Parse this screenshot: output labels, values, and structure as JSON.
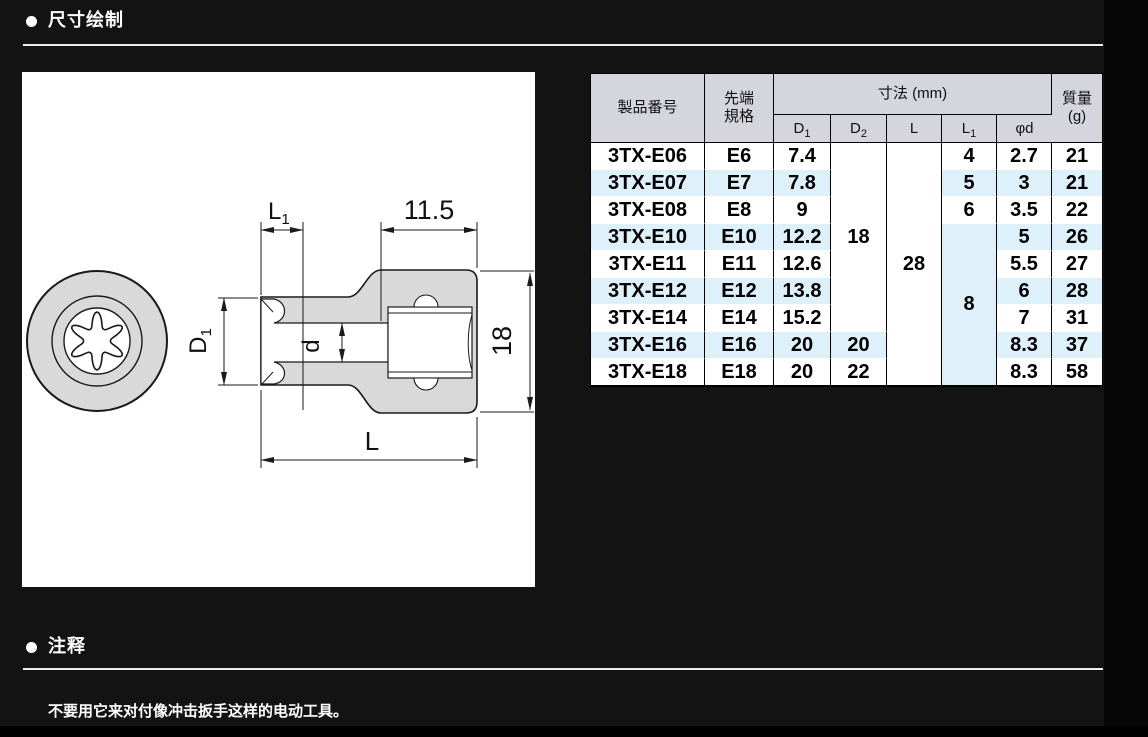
{
  "sections": {
    "drawing": {
      "title": "尺寸绘制"
    },
    "notes": {
      "title": "注释",
      "body": "不要用它来对付像冲击扳手这样的电动工具。"
    }
  },
  "drawing": {
    "labels": {
      "l1": {
        "base": "L",
        "sub": "1"
      },
      "top_width": "11.5",
      "d1": {
        "base": "D",
        "sub": "1"
      },
      "d": "d",
      "height": "18",
      "length": "L"
    }
  },
  "table": {
    "headers": {
      "product": "製品番号",
      "tip_line1": "先端",
      "tip_line2": "規格",
      "dims_group": "寸法 (mm)",
      "dims": [
        {
          "b": "D",
          "s": "1"
        },
        {
          "b": "D",
          "s": "2"
        },
        {
          "b": "L",
          "s": ""
        },
        {
          "b": "L",
          "s": "1"
        },
        {
          "b": "φd",
          "s": ""
        }
      ],
      "mass_line1": "質量",
      "mass_line2": "(g)"
    },
    "rows": [
      {
        "product": "3TX-E06",
        "tip": "E6",
        "d1": "7.4",
        "d1a": "r",
        "l1": "4",
        "phid": "2.7",
        "mass": "21"
      },
      {
        "product": "3TX-E07",
        "tip": "E7",
        "d1": "7.8",
        "d1a": "r",
        "l1": "5",
        "phid": "3",
        "mass": "21"
      },
      {
        "product": "3TX-E08",
        "tip": "E8",
        "d1": "9",
        "l1": "6",
        "phid": "3.5",
        "mass": "22"
      },
      {
        "product": "3TX-E10",
        "tip": "E10",
        "d1": "12.2",
        "phid": "5",
        "mass": "26"
      },
      {
        "product": "3TX-E11",
        "tip": "E11",
        "d1": "12.6",
        "phid": "5.5",
        "mass": "27"
      },
      {
        "product": "3TX-E12",
        "tip": "E12",
        "d1": "13.8",
        "phid": "6",
        "mass": "28"
      },
      {
        "product": "3TX-E14",
        "tip": "E14",
        "d1": "15.2",
        "phid": "7",
        "mass": "31"
      },
      {
        "product": "3TX-E16",
        "tip": "E16",
        "d1": "20",
        "d1a": "l",
        "d2": "20",
        "phid": "8.3",
        "mass": "37"
      },
      {
        "product": "3TX-E18",
        "tip": "E18",
        "d1": "20",
        "d1a": "l",
        "d2": "22",
        "phid": "8.3",
        "mass": "58"
      }
    ],
    "spans": [
      {
        "col": "d2",
        "row": 0,
        "rowspan": 7,
        "value": "18",
        "bg": "white"
      },
      {
        "col": "l",
        "row": 0,
        "rowspan": 9,
        "value": "28",
        "bg": "white"
      },
      {
        "col": "l1",
        "row": 3,
        "rowspan": 6,
        "value": "8",
        "bg": "blue"
      }
    ]
  },
  "colors": {
    "content_bg": "#131313",
    "header_bg": "#d5d5dd",
    "stripe_blue": "#def0fa",
    "drawing_gray": "#d9d9d9",
    "rule_white": "#ededed"
  }
}
